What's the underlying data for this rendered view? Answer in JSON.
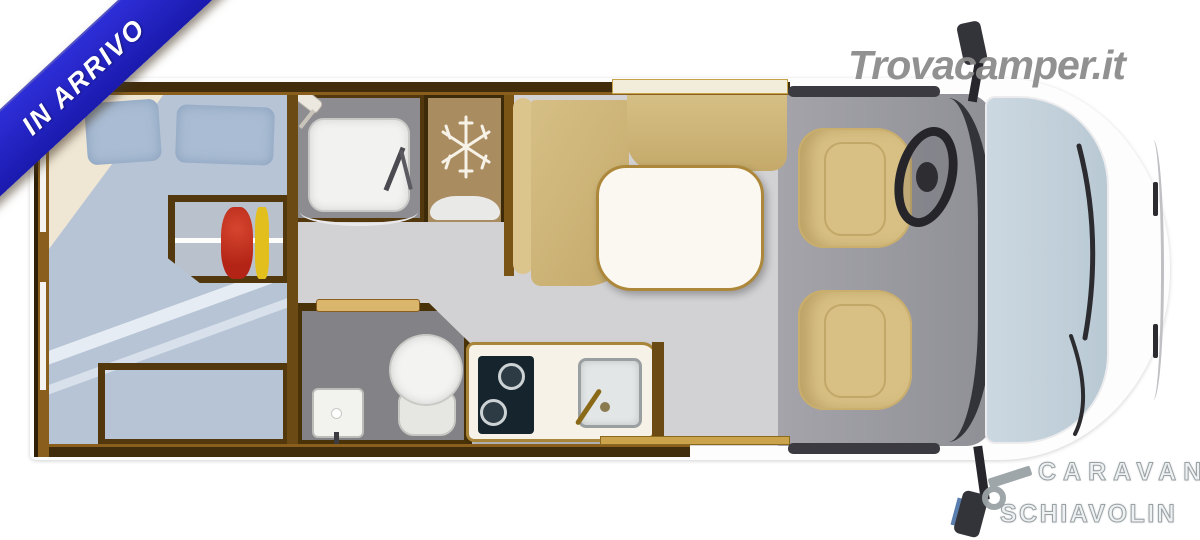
{
  "badge": {
    "label": "IN ARRIVO",
    "bg": "#2323c8",
    "text_color": "#ffffff"
  },
  "watermark": {
    "text": "Trovacamper.it",
    "color": "#8c8c8c"
  },
  "dealer": {
    "line1": "CARAVAN",
    "line2": "SCHIAVOLIN",
    "flag_colors": [
      "#3f8f43",
      "#f2f2f2",
      "#c63c3c"
    ]
  },
  "icons": {
    "fridge_icon": "snowflake"
  },
  "palette": {
    "ribbon_blue": "#2626c9",
    "wood_dark": "#4a3208",
    "wood_light": "#a9853a",
    "floor_gray": "#d2d2d4",
    "cab_floor_gray": "#9b9ba1",
    "bed_blue": "#b7c4d5",
    "seat_tan": "#d8c084",
    "bench_tan": "#cdb478",
    "windshield_blue": "#c5d3dd",
    "clothes_red": "#c8301e",
    "clothes_yellow": "#e2bf1c",
    "clothes_blue": "#7a9ccf",
    "hob_dark": "#16242d"
  }
}
